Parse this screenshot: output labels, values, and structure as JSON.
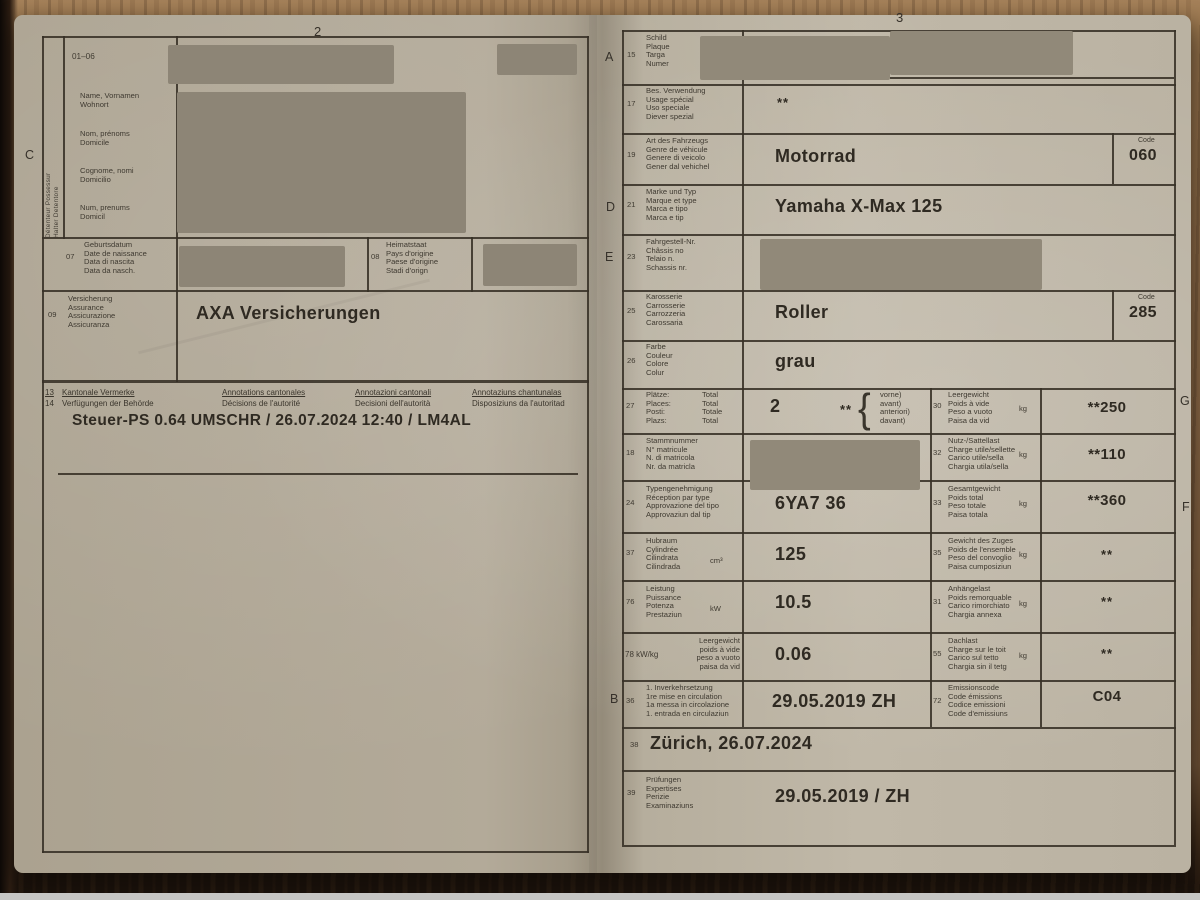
{
  "photo": {
    "left_page_number": "2",
    "right_page_number": "3"
  },
  "markers": {
    "c": "C",
    "a": "A",
    "d": "D",
    "e": "E",
    "b": "B",
    "g": "G",
    "f": "F"
  },
  "left": {
    "holder_strip": {
      "line1": "Détenteur   Possessur",
      "line2": "Halter   Detentore"
    },
    "block0106": {
      "num": "01–06",
      "groups": [
        [
          "Name, Vornamen",
          "Wohnort"
        ],
        [
          "Nom, prénoms",
          "Domicile"
        ],
        [
          "Cognome, nomi",
          "Domicilio"
        ],
        [
          "Num, prenums",
          "Domicil"
        ]
      ]
    },
    "f07": {
      "num": "07",
      "labels": [
        "Geburtsdatum",
        "Date de naissance",
        "Data di nascita",
        "Data da nasch."
      ]
    },
    "f08": {
      "num": "08",
      "labels": [
        "Heimatstaat",
        "Pays d'origine",
        "Paese d'origine",
        "Stadi d'orign"
      ]
    },
    "f09": {
      "num": "09",
      "labels": [
        "Versicherung",
        "Assurance",
        "Assicurazione",
        "Assicuranza"
      ],
      "value": "AXA Versicherungen"
    },
    "remarks": {
      "col1": {
        "nums": [
          "13",
          "14"
        ],
        "lines": [
          "Kantonale Vermerke",
          "Verfügungen der Behörde"
        ]
      },
      "col2": {
        "lines": [
          "Annotations cantonales",
          "Décisions de l'autorité"
        ]
      },
      "col3": {
        "lines": [
          "Annotazioni cantonali",
          "Decisioni dell'autorità"
        ]
      },
      "col4": {
        "lines": [
          "Annotaziuns chantunalas",
          "Disposiziuns da l'autoritad"
        ]
      },
      "entry": "Steuer-PS  0.64  UMSCHR / 26.07.2024 12:40 / LM4AL"
    }
  },
  "right": {
    "r15": {
      "num": "15",
      "labels": [
        "Schild",
        "Plaque",
        "Targa",
        "Numer"
      ]
    },
    "r17": {
      "num": "17",
      "labels": [
        "Bes. Verwendung",
        "Usage spécial",
        "Uso speciale",
        "Diever spezial"
      ],
      "value": "**"
    },
    "r19": {
      "num": "19",
      "labels": [
        "Art des Fahrzeugs",
        "Genre de véhicule",
        "Genere di veicolo",
        "Gener dal vehichel"
      ],
      "value": "Motorrad",
      "code_label": "Code",
      "code": "060"
    },
    "r21": {
      "num": "21",
      "labels": [
        "Marke und Typ",
        "Marque et type",
        "Marca e tipo",
        "Marca e tip"
      ],
      "value": "Yamaha X-Max 125"
    },
    "r23": {
      "num": "23",
      "labels": [
        "Fahrgestell-Nr.",
        "Châssis no",
        "Telaio n.",
        "Schassis nr."
      ]
    },
    "r25": {
      "num": "25",
      "labels": [
        "Karosserie",
        "Carrosserie",
        "Carrozzeria",
        "Carossaria"
      ],
      "value": "Roller",
      "code_label": "Code",
      "code": "285"
    },
    "r26": {
      "num": "26",
      "labels": [
        "Farbe",
        "Couleur",
        "Colore",
        "Colur"
      ],
      "value": "grau"
    },
    "r27": {
      "num": "27",
      "labels": [
        "Plätze:",
        "Places:",
        "Posti:",
        "Plazs:"
      ],
      "totals": [
        "Total",
        "Total",
        "Totale",
        "Total"
      ],
      "value": "2",
      "stars": "**",
      "brace": "{",
      "paren": [
        "vorne)",
        "avant)",
        "anteriori)",
        "davant)"
      ]
    },
    "r30": {
      "num": "30",
      "labels": [
        "Leergewicht",
        "Poids à vide",
        "Peso a vuoto",
        "Paisa da vid"
      ],
      "unit": "kg",
      "value": "**250"
    },
    "r18": {
      "num": "18",
      "labels": [
        "Stammnummer",
        "N° matricule",
        "N. di matricola",
        "Nr. da matricla"
      ]
    },
    "r32": {
      "num": "32",
      "labels": [
        "Nutz-/Sattellast",
        "Charge utile/sellette",
        "Carico utile/sella",
        "Chargia utila/sella"
      ],
      "unit": "kg",
      "value": "**110"
    },
    "r24": {
      "num": "24",
      "labels": [
        "Typengenehmigung",
        "Réception par type",
        "Approvazione del tipo",
        "Approvaziun dal tip"
      ],
      "value": "6YA7 36"
    },
    "r33": {
      "num": "33",
      "labels": [
        "Gesamtgewicht",
        "Poids total",
        "Peso totale",
        "Paisa totala"
      ],
      "unit": "kg",
      "value": "**360"
    },
    "r37": {
      "num": "37",
      "labels": [
        "Hubraum",
        "Cylindrée",
        "Cilindrata",
        "Cilindrada"
      ],
      "unit": "cm³",
      "value": "125"
    },
    "r35": {
      "num": "35",
      "labels": [
        "Gewicht des Zuges",
        "Poids de l'ensemble",
        "Peso del convoglio",
        "Paisa cumposiziun"
      ],
      "unit": "kg",
      "value": "**"
    },
    "r76": {
      "num": "76",
      "labels": [
        "Leistung",
        "Puissance",
        "Potenza",
        "Prestaziun"
      ],
      "unit": "kW",
      "value": "10.5"
    },
    "r31": {
      "num": "31",
      "labels": [
        "Anhängelast",
        "Poids remorquable",
        "Carico rimorchiato",
        "Chargia annexa"
      ],
      "unit": "kg",
      "value": "**"
    },
    "r78": {
      "num": "78 kW/kg",
      "labels": [
        "Leergewicht",
        "poids à vide",
        "peso a vuoto",
        "paisa da vid"
      ],
      "value": "0.06"
    },
    "r55": {
      "num": "55",
      "labels": [
        "Dachlast",
        "Charge sur le toit",
        "Carico sul tetto",
        "Chargia sin il tetg"
      ],
      "unit": "kg",
      "value": "**"
    },
    "r36": {
      "num": "36",
      "labels": [
        "1. Inverkehrsetzung",
        "1re mise en circulation",
        "1a messa in circolazione",
        "1. entrada en circulaziun"
      ],
      "value": "29.05.2019 ZH"
    },
    "r72": {
      "num": "72",
      "labels": [
        "Emissionscode",
        "Code émissions",
        "Codice emissioni",
        "Code d'emissiuns"
      ],
      "value": "C04"
    },
    "r38": {
      "num": "38",
      "value": "Zürich, 26.07.2024"
    },
    "r39": {
      "num": "39",
      "labels": [
        "Prüfungen",
        "Expertises",
        "Perizie",
        "Examinaziuns"
      ],
      "value": "29.05.2019 / ZH"
    }
  }
}
